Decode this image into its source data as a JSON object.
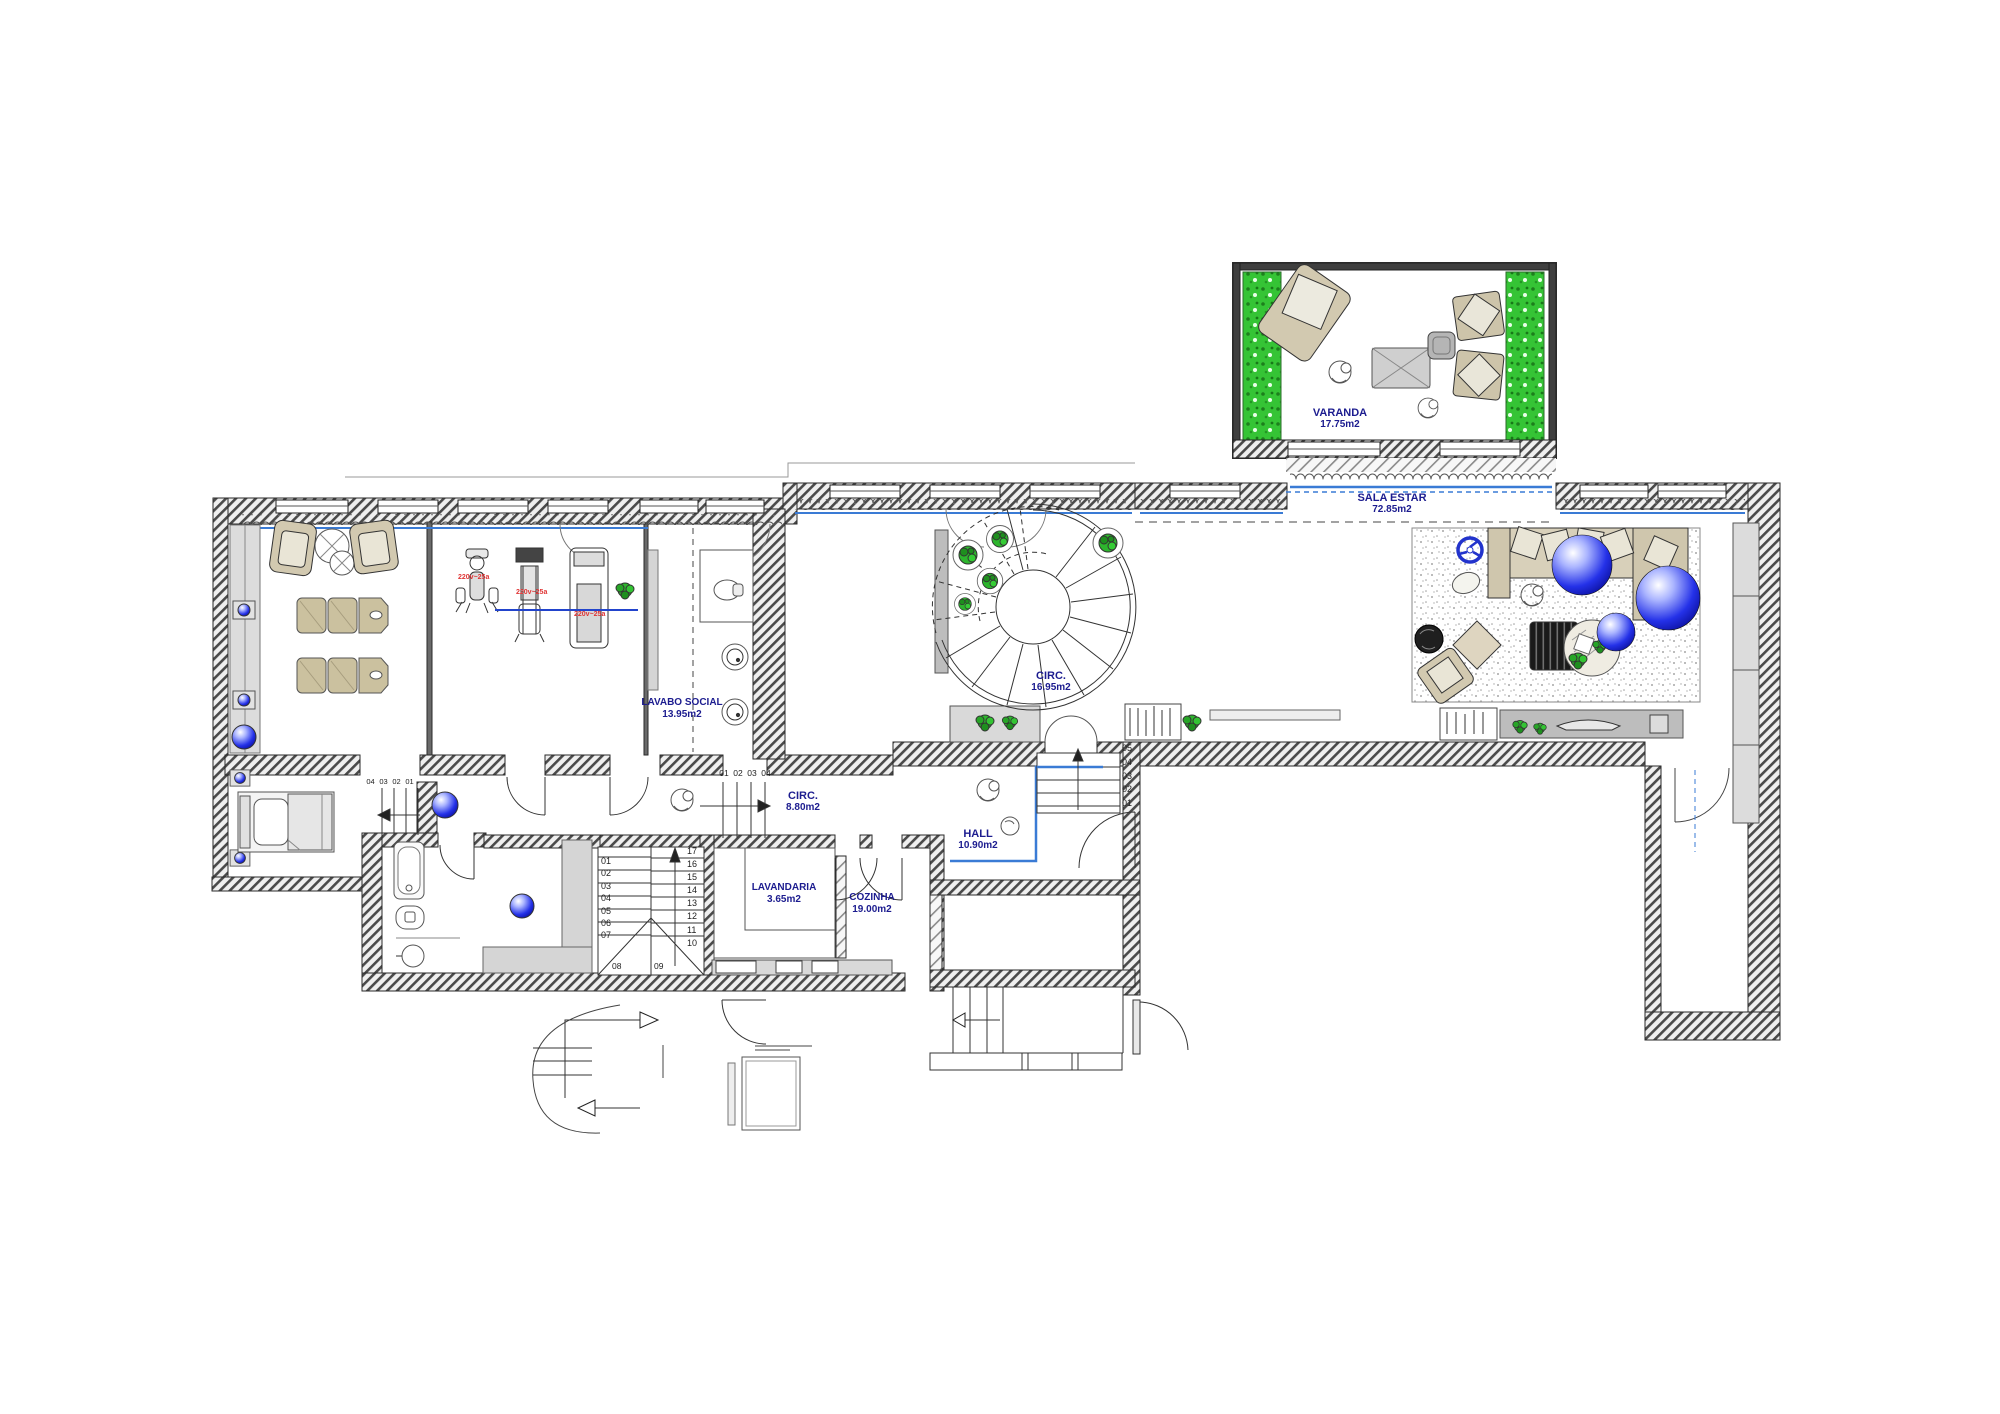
{
  "rooms": [
    {
      "name": "VARANDA",
      "area": "17.75m2"
    },
    {
      "name": "SALA ESTAR",
      "area": "72.85m2"
    },
    {
      "name": "CIRC.",
      "area": "16.95m2"
    },
    {
      "name": "LAVABO SOCIAL",
      "area": "13.95m2"
    },
    {
      "name": "CIRC.",
      "area": "8.80m2"
    },
    {
      "name": "HALL",
      "area": "10.90m2"
    },
    {
      "name": "LAVANDARIA",
      "area": "3.65m2"
    },
    {
      "name": "COZINHA",
      "area": "19.00m2"
    }
  ],
  "equipment_labels": [
    "220v~25a",
    "220v~25a",
    "220v~25a"
  ],
  "stairs": {
    "main_left": [
      "01",
      "02",
      "03",
      "04",
      "05",
      "06",
      "07"
    ],
    "main_right": [
      "17",
      "16",
      "15",
      "14",
      "13",
      "12",
      "11",
      "10"
    ],
    "main_landing": [
      "08",
      "09"
    ],
    "corridor": [
      "01",
      "02",
      "03",
      "04"
    ],
    "hall": [
      "05",
      "04",
      "03",
      "02",
      "01"
    ],
    "annex": [
      "04",
      "03",
      "02",
      "01"
    ]
  },
  "colors": {
    "label_blue": "#1c1c8f",
    "equipment_red": "#e03535",
    "glazing_blue": "#3a7bd5",
    "hedge_green": "#2fbe2f",
    "plant_green": "#27b327",
    "sphere_blue": "#2431e8",
    "furniture_beige": "#d2c9b0",
    "wall_gray": "#4a4a4a"
  }
}
